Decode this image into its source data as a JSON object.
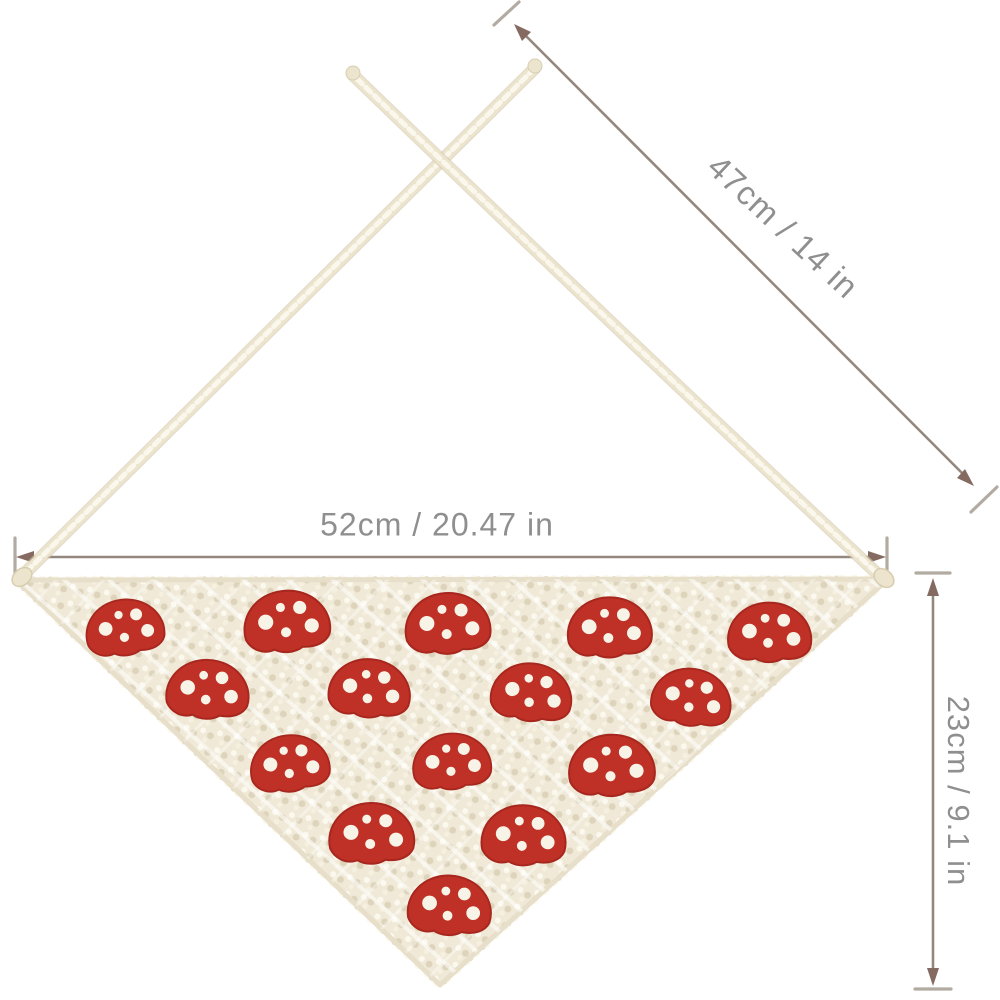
{
  "image": {
    "kind": "e-commerce product dimension photo",
    "subject": "crochet triangle bandana head scarf with mushroom pattern and tie straps",
    "background_color": "#ffffff"
  },
  "colors": {
    "background": "#ffffff",
    "fabric": "#f0e9d7",
    "fabric_hi": "#fbf8ee",
    "fabric_sh": "#ddd4bb",
    "fabric_hi2": "#f6f0e0",
    "fabric_edge": "#e7dfca",
    "tie": "#ece4cd",
    "tie_shadow": "#d7cdb0",
    "tie_hi": "#faf7ed",
    "mushroom": "#bf3026",
    "mushroom_dark": "#a7271e",
    "dot": "#f8f3e7",
    "dim_line": "#94877d",
    "dim_arrow": "#846a60",
    "dim_tick": "#b2aba1",
    "dim_text": "#8f8f8f"
  },
  "annotations": {
    "strap": {
      "label": "47cm / 14 in",
      "cm": 47,
      "in": 14,
      "orientation": "diagonal"
    },
    "width": {
      "label": "52cm / 20.47 in",
      "cm": 52,
      "in": 20.47,
      "orientation": "horizontal"
    },
    "height": {
      "label": "23cm / 9.1 in",
      "cm": 23,
      "in": 9.1,
      "orientation": "vertical"
    }
  },
  "product": {
    "motif": "red mushroom cap with white dots",
    "motif_count": 15,
    "rows": [
      5,
      4,
      3,
      2,
      1
    ],
    "triangle": {
      "top_left": [
        16,
        580
      ],
      "top_right": [
        888,
        579
      ],
      "bottom": [
        440,
        985
      ]
    },
    "ties": {
      "left": {
        "from": [
          18,
          580
        ],
        "to": [
          535,
          68
        ]
      },
      "right": {
        "from": [
          884,
          580
        ],
        "to": [
          353,
          75
        ]
      }
    },
    "mushrooms": [
      [
        125,
        628
      ],
      [
        287,
        622
      ],
      [
        448,
        624
      ],
      [
        610,
        628
      ],
      [
        770,
        633
      ],
      [
        208,
        690
      ],
      [
        370,
        689
      ],
      [
        532,
        693
      ],
      [
        692,
        698
      ],
      [
        290,
        764
      ],
      [
        452,
        762
      ],
      [
        612,
        766
      ],
      [
        372,
        834
      ],
      [
        524,
        836
      ],
      [
        450,
        906
      ]
    ]
  }
}
